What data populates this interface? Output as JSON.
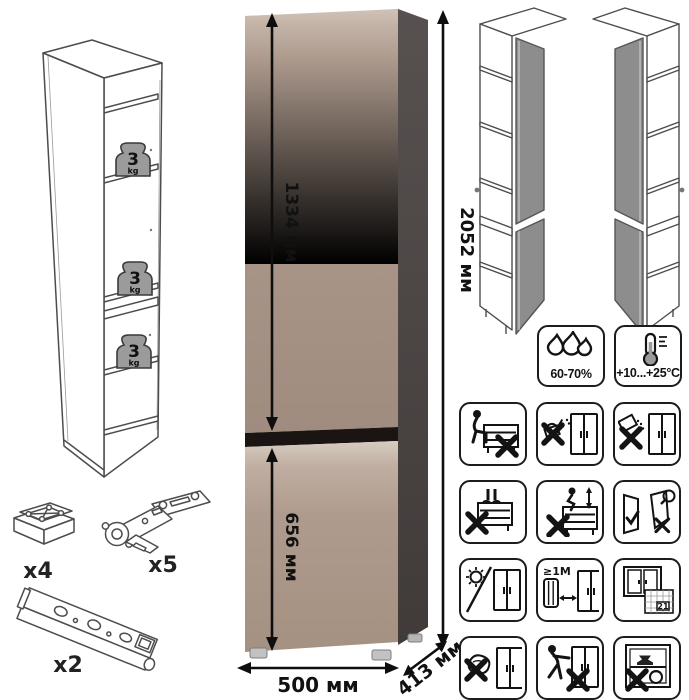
{
  "diagram": {
    "dimensions": {
      "upper_section_height": "1334 мм",
      "lower_section_height": "656 мм",
      "total_height": "2052 мм",
      "width": "500 мм",
      "depth": "413 мм"
    },
    "shelf_load": {
      "value": "3",
      "unit": "kg"
    },
    "hardware": {
      "foot_qty": "x4",
      "hinge_qty": "x5",
      "rail_qty": "x2"
    },
    "climate": {
      "humidity_range": "60-70%",
      "temperature_range": "+10...+25°C"
    },
    "care": {
      "min_heat_distance": "≥1M",
      "calendar_day": "21"
    },
    "colors": {
      "front_taupe": "#a9958a",
      "front_highlight": "#d2c4b9",
      "side_dark": "#4a4442",
      "door_gap": "#1a1512",
      "open_door_gray": "#8d8d8d",
      "outline": "#4d4d4d"
    }
  }
}
